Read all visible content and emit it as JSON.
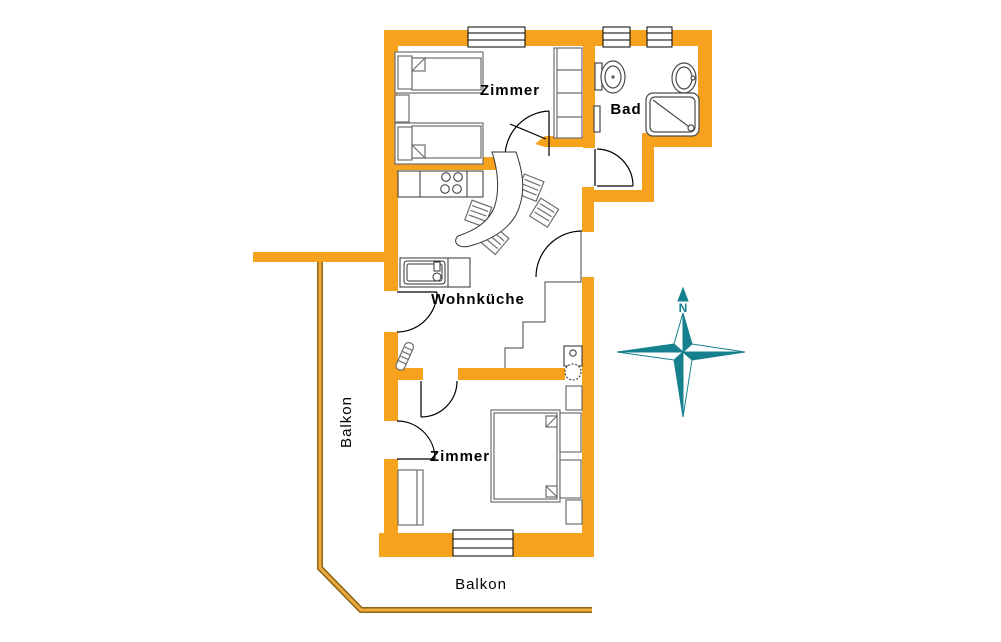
{
  "floor_plan": {
    "labels": {
      "room_top": "Zimmer",
      "bathroom": "Bad",
      "living_kitchen": "Wohnküche",
      "room_bottom": "Zimmer",
      "balcony_left": "Balkon",
      "balcony_bottom": "Balkon",
      "compass_north": "N"
    },
    "colors": {
      "wall": "#F6A21C",
      "railing_dark": "#8B6914",
      "railing_light": "#EFA93C",
      "furniture": "#6e6e6e",
      "kitchen_outline": "#333333",
      "fixture": "#4a4a4a",
      "door_line": "#000000",
      "floor_edge_line": "#444444",
      "label_text": "#000000",
      "compass": "#17808F",
      "background": "#ffffff"
    }
  }
}
